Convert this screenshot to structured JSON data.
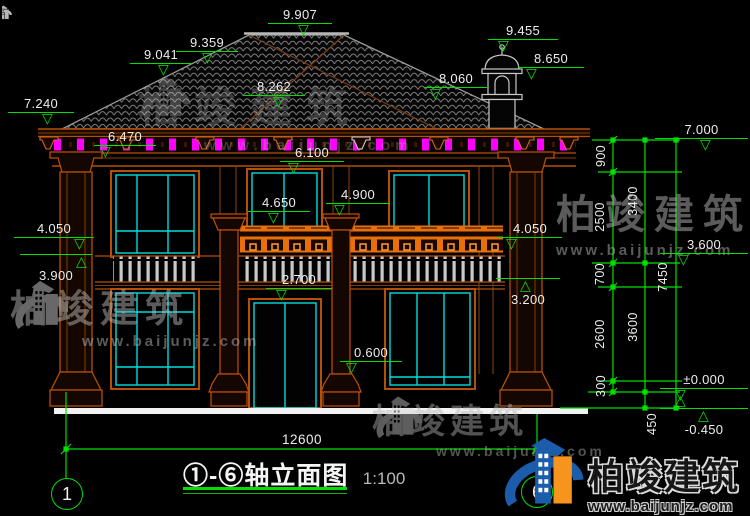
{
  "brand": {
    "name": "柏竣建筑",
    "url": "www.baijunjz.com"
  },
  "title_block": {
    "title": "①-⑥轴立面图",
    "scale": "1:100"
  },
  "axes": {
    "start": "1",
    "end": "6"
  },
  "dims": {
    "overall_width": "12600",
    "chain_inner": [
      "900",
      "2500",
      "700",
      "2600",
      "300"
    ],
    "chain_mid": [
      "3400",
      "3600",
      "450"
    ],
    "chain_outer": [
      "7450"
    ]
  },
  "levels": {
    "ridge": "9.907",
    "turret_top": "9.455",
    "left_roof_upper": "9.359",
    "left_roof_lower": "9.041",
    "turret_balcony": "8.650",
    "roof_valley": "8.262",
    "right_roof": "8.060",
    "eave_left": "7.240",
    "eave_right": "7.000",
    "eave_soffit": "6.470",
    "head_2f": "6.100",
    "post_capital": "4.900",
    "balcony_rail": "4.650",
    "rail_left": "4.050",
    "rail_right": "4.050",
    "sill_2f": "3.900",
    "floor_2f": "3.600",
    "beam_soffit": "3.200",
    "slab_bottom": "2.700",
    "canopy": "0.600",
    "ground_floor": "±0.000",
    "site_ground": "-0.450"
  }
}
